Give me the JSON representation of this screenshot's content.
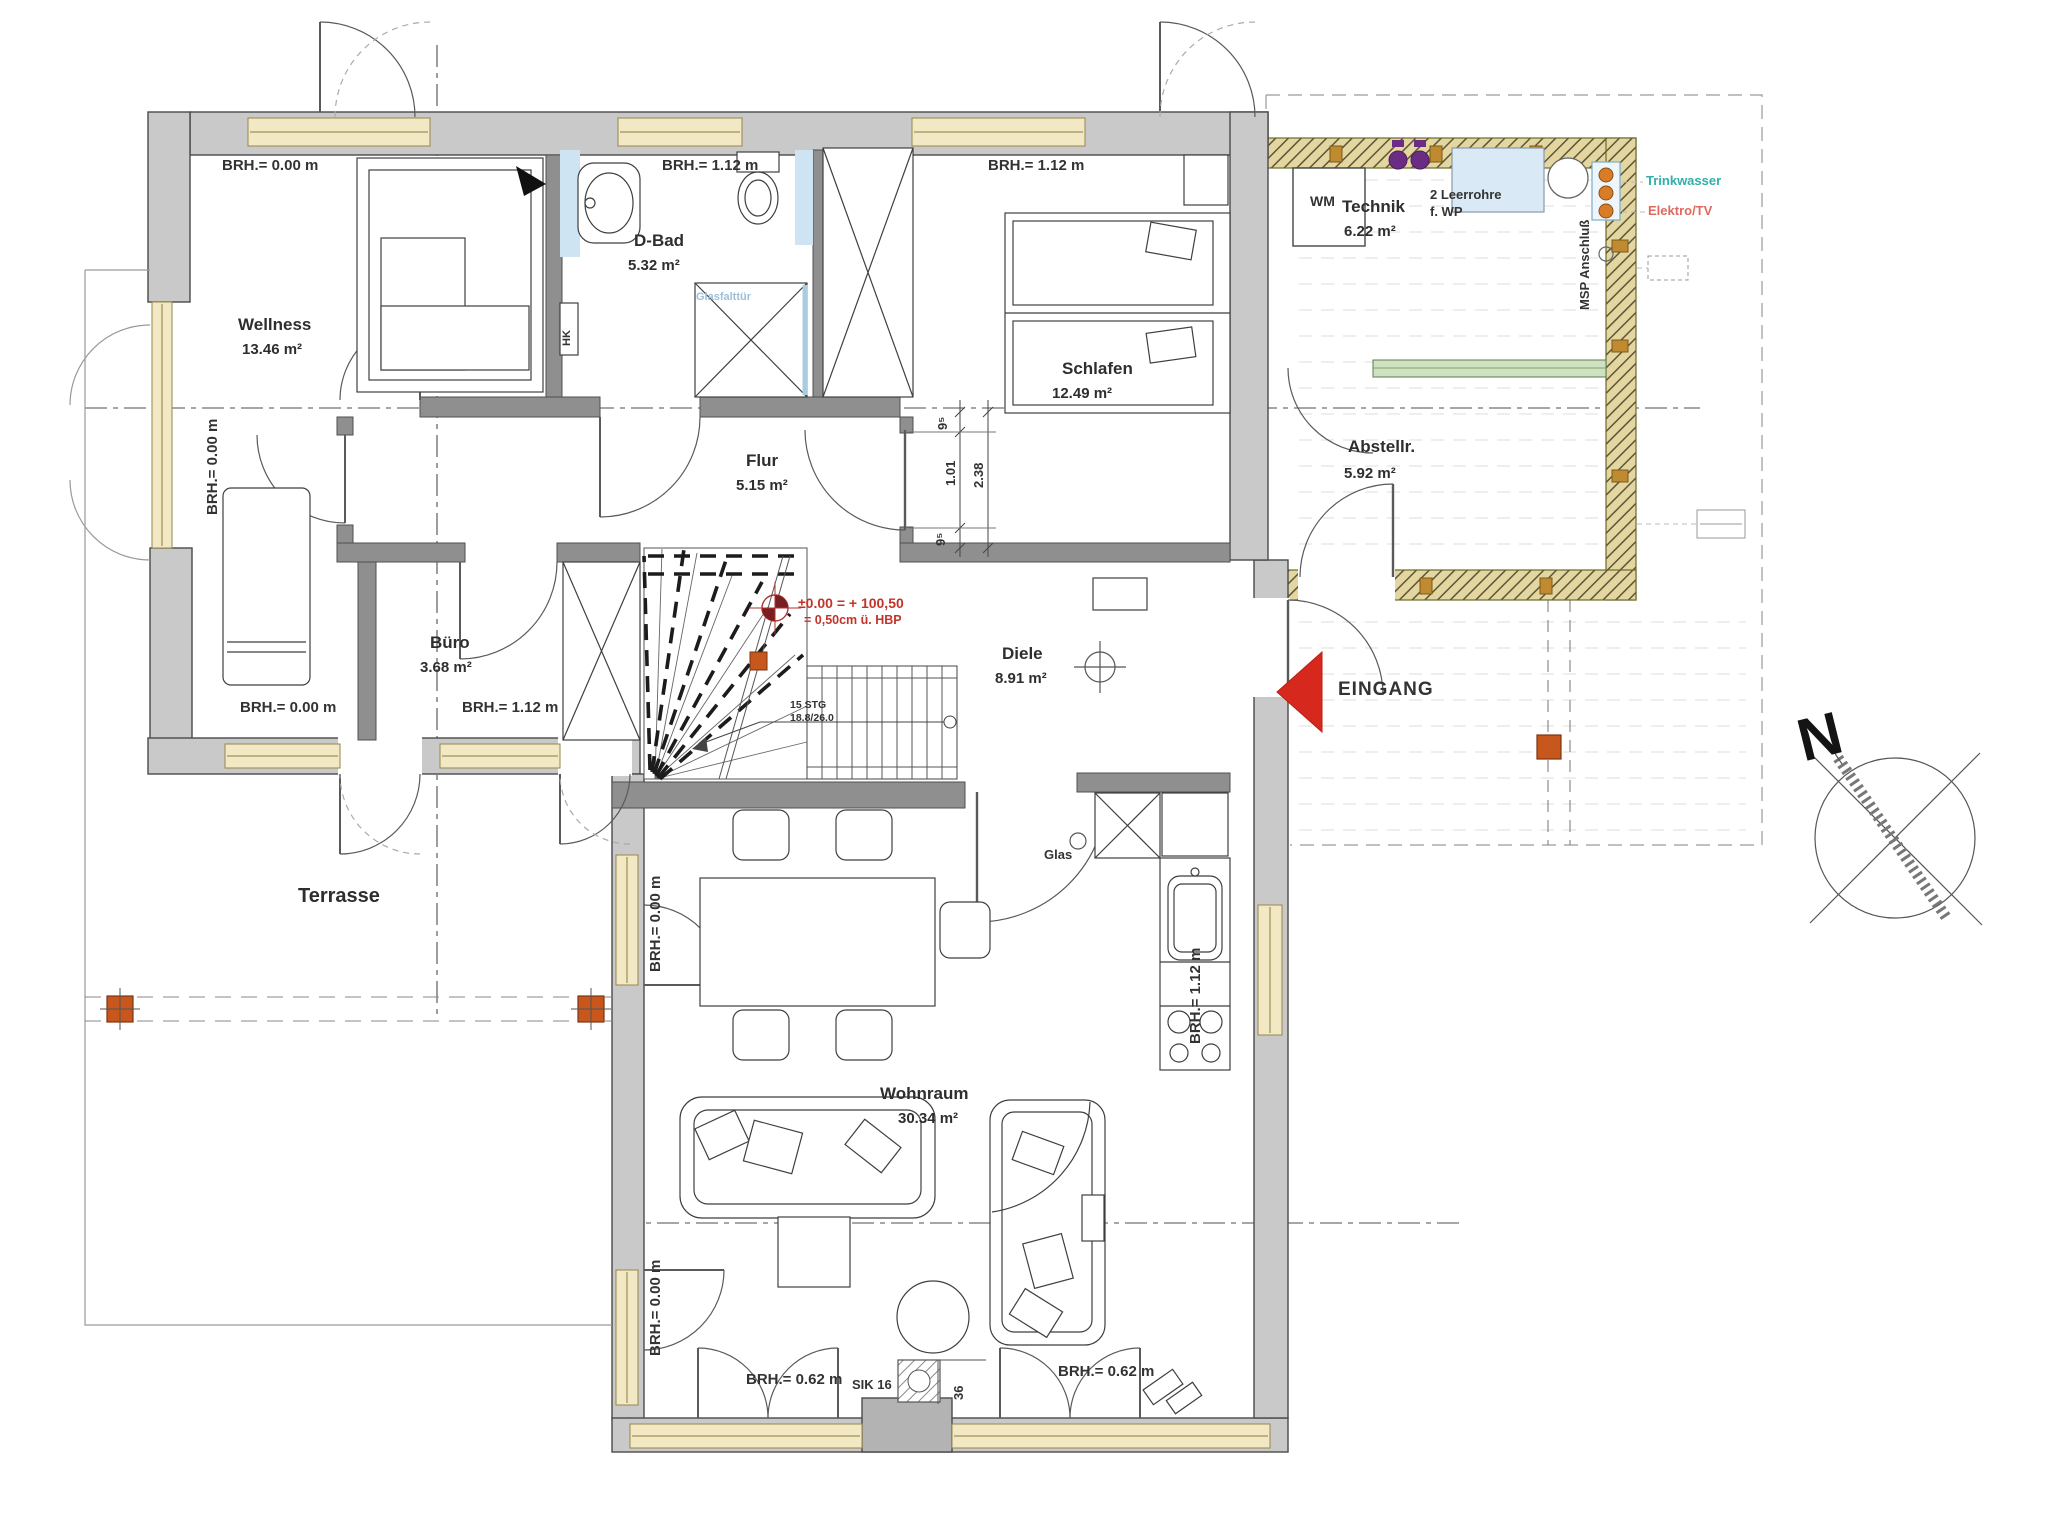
{
  "plan_type": "floor-plan",
  "rooms": {
    "wellness": {
      "name": "Wellness",
      "area": "13.46 m²"
    },
    "dbad": {
      "name": "D-Bad",
      "area": "5.32 m²"
    },
    "schlafen": {
      "name": "Schlafen",
      "area": "12.49 m²"
    },
    "technik": {
      "name": "Technik",
      "area": "6.22 m²"
    },
    "abstellraum": {
      "name": "Abstellr.",
      "area": "5.92 m²"
    },
    "flur": {
      "name": "Flur",
      "area": "5.15 m²"
    },
    "buero": {
      "name": "Büro",
      "area": "3.68 m²"
    },
    "diele": {
      "name": "Diele",
      "area": "8.91 m²"
    },
    "terrasse": {
      "name": "Terrasse"
    },
    "wohnraum": {
      "name": "Wohnraum",
      "area": "30.34 m²"
    }
  },
  "sill_heights": {
    "h000": "BRH.= 0.00 m",
    "h062": "BRH.= 0.62 m",
    "h112": "BRH.= 1.12 m"
  },
  "labels": {
    "wm": "WM",
    "hk": "HK",
    "glass_folding_door": "Glasfalttür",
    "empty_conduits_1": "2 Leerrohre",
    "empty_conduits_2": "f. WP",
    "msp": "MSP Anschluß",
    "drinking_water": "Trinkwasser",
    "electro_tv": "Elektro/TV",
    "entrance": "EINGANG",
    "glass": "Glas",
    "chimney": "SIK 16",
    "chimney_dim": "36",
    "stairs_1": "15 STG",
    "stairs_2": "18.8/26.0",
    "level_line1": "±0.00 = + 100,50",
    "level_line2": "= 0,50cm ü. HBP",
    "north": "N"
  },
  "dimensions": {
    "d95": "9⁵",
    "d101": "1.01",
    "d238": "2.38"
  },
  "colors": {
    "wall": "#c9c9c9",
    "interior_wall": "#8f8f8f",
    "window": "#f2e8c4",
    "timber": "#e3d6a0",
    "entrance_red": "#d7281e",
    "drinking_water_cyan": "#2fb0a8",
    "electro_red": "#e06a5f",
    "conduit_purple": "#6b2d83",
    "post_orange": "#c8571d",
    "fixture_blue": "#d9eaf6",
    "glass_green": "#cfe0c3"
  }
}
